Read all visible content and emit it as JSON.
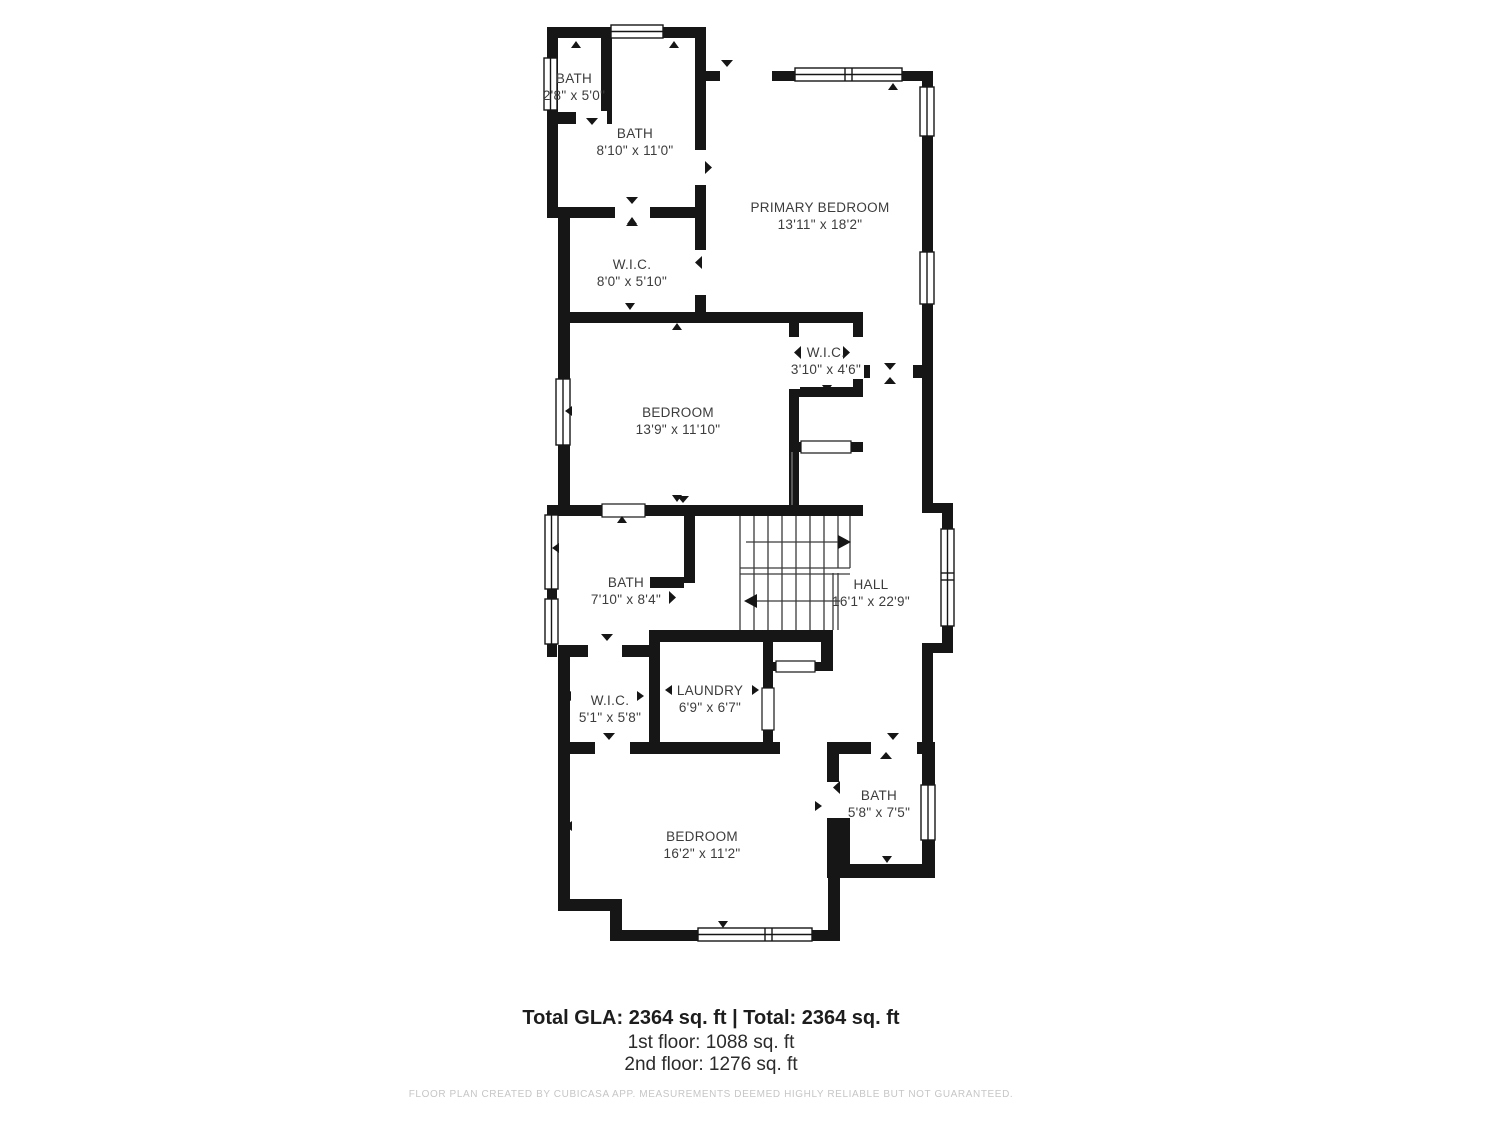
{
  "floorplan": {
    "rooms": [
      {
        "name": "BATH",
        "dims": "2'8\" x 5'0\""
      },
      {
        "name": "BATH",
        "dims": "8'10\" x 11'0\""
      },
      {
        "name": "PRIMARY BEDROOM",
        "dims": "13'11\" x 18'2\""
      },
      {
        "name": "W.I.C.",
        "dims": "8'0\" x 5'10\""
      },
      {
        "name": "BEDROOM",
        "dims": "13'9\" x 11'10\""
      },
      {
        "name": "W.I.C.",
        "dims": "3'10\" x 4'6\""
      },
      {
        "name": "BATH",
        "dims": "7'10\" x 8'4\""
      },
      {
        "name": "HALL",
        "dims": "16'1\" x 22'9\""
      },
      {
        "name": "W.I.C.",
        "dims": "5'1\" x 5'8\""
      },
      {
        "name": "LAUNDRY",
        "dims": "6'9\" x 6'7\""
      },
      {
        "name": "BATH",
        "dims": "5'8\" x 7'5\""
      },
      {
        "name": "BEDROOM",
        "dims": "16'2\" x 11'2\""
      }
    ],
    "summary": {
      "total": "Total GLA: 2364 sq. ft | Total: 2364 sq. ft",
      "first_floor": "1st floor: 1088 sq. ft",
      "second_floor": "2nd floor: 1276 sq. ft"
    },
    "disclaimer": "FLOOR PLAN CREATED BY CUBICASA APP. MEASUREMENTS DEEMED HIGHLY RELIABLE BUT NOT GUARANTEED.",
    "colors": {
      "wall": "#161616",
      "label_text": "#3c3c3c",
      "disclaimer_text": "#c6c6c6"
    }
  }
}
